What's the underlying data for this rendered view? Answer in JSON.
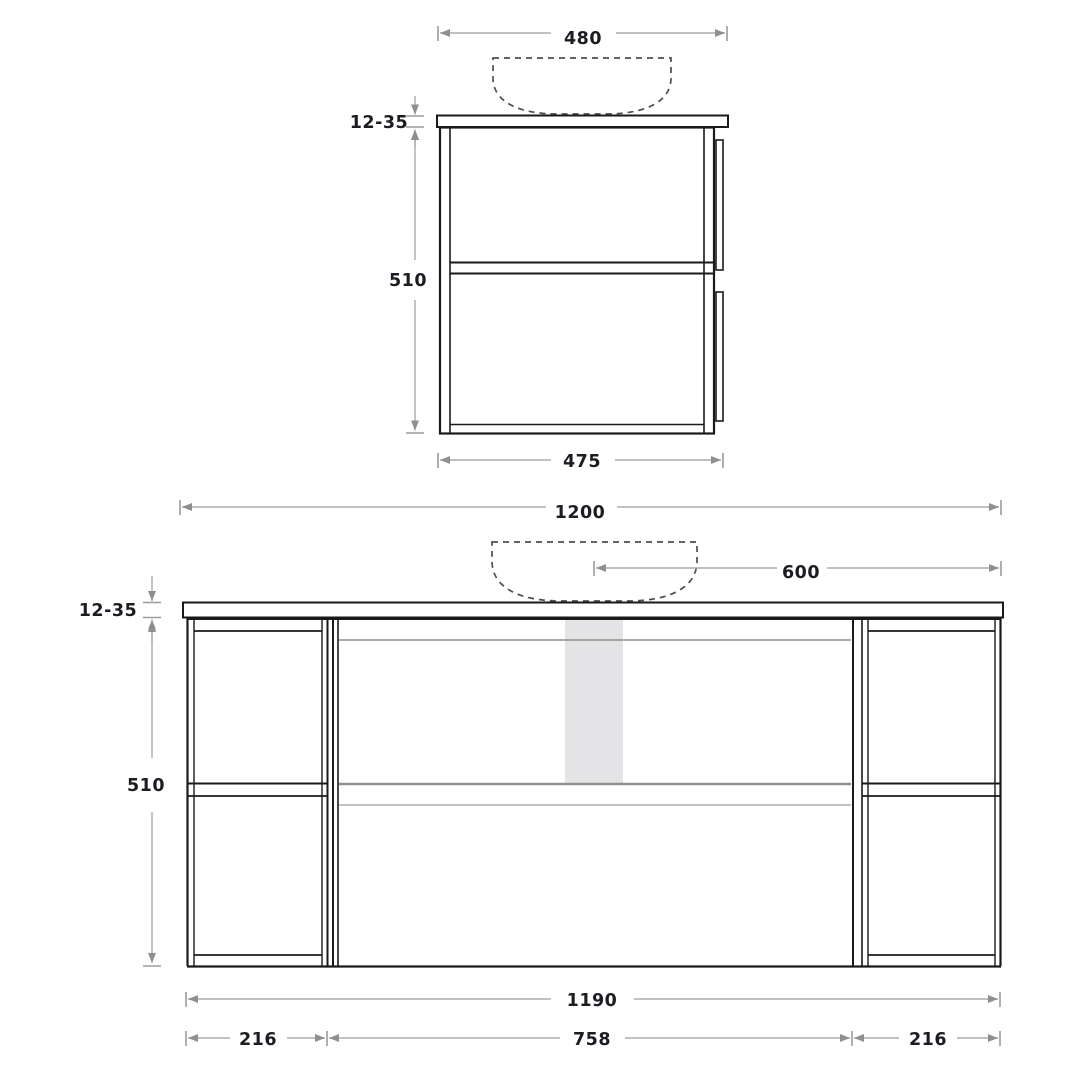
{
  "drawing": {
    "title": "vanity-unit-technical-drawing",
    "colors": {
      "background": "#ffffff",
      "outline": "#1a1a1a",
      "dimension_line": "#ababab",
      "dashed_basin": "#4f4f4f",
      "shaded_strip": "#e4e4e7",
      "label_text": "#1c1c22"
    },
    "side_view": {
      "top_width": "480",
      "top_thickness": "12-35",
      "height": "510",
      "bottom_depth": "475"
    },
    "front_view": {
      "total_width": "1200",
      "basin_center_to_edge": "600",
      "top_thickness": "12-35",
      "height": "510",
      "cabinet_width": "1190",
      "left_cabinet_width": "216",
      "middle_section_width": "758",
      "right_cabinet_width": "216"
    }
  }
}
